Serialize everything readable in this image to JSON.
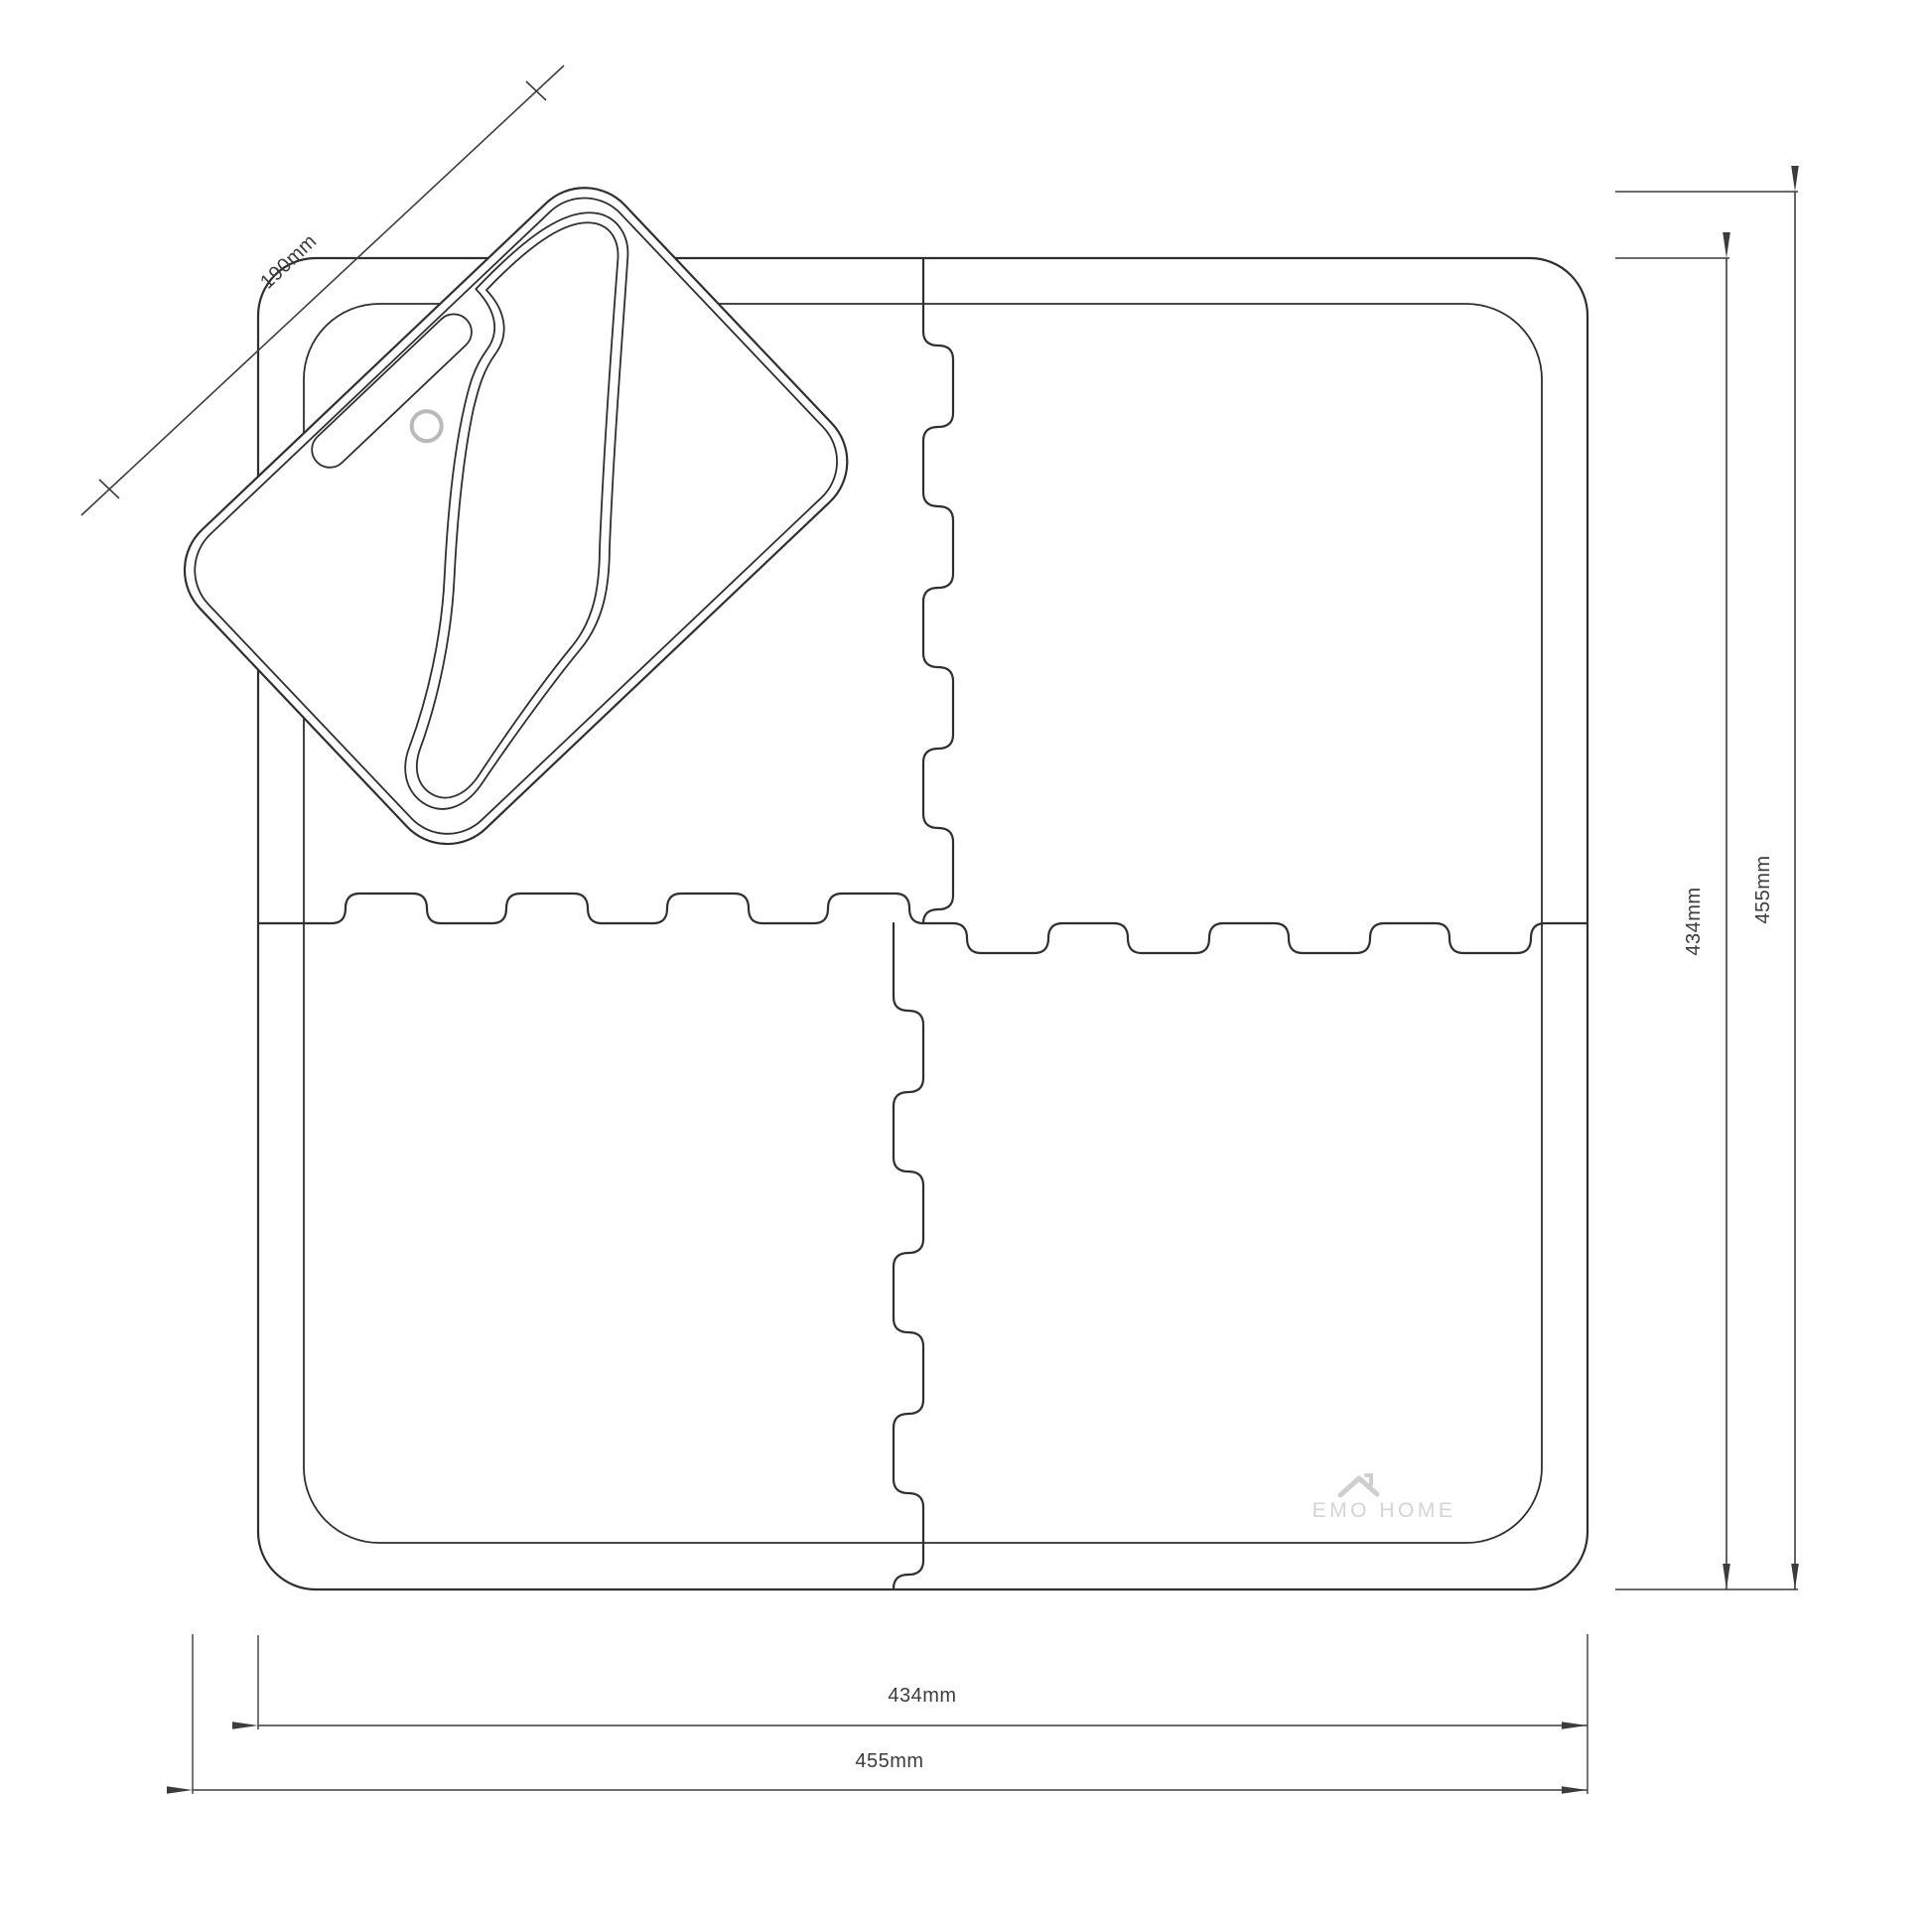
{
  "diagram": {
    "type": "technical-line-drawing",
    "subject": "interlocking foam mat set with carry kneeling pad",
    "dimension_labels": {
      "pad_length": "190mm",
      "width_inner": "434mm",
      "width_overall": "455mm",
      "height_inner": "434mm",
      "height_overall": "455mm"
    },
    "logo_text": "EMO HOME",
    "colors": {
      "line": "#2f2f2f",
      "dim": "#3c3c3c",
      "logo": "#d4d4d4",
      "background": "#ffffff"
    }
  }
}
